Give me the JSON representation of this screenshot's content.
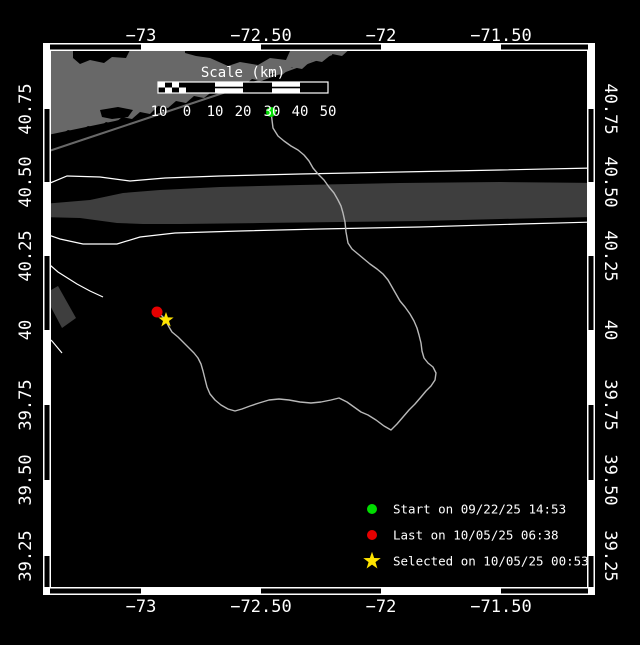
{
  "colors": {
    "background": "#000000",
    "sea": "#000000",
    "land": "#686868",
    "lane": "#3e3e3e",
    "boundary_line": "#ffffff",
    "track": "#b8b8b8",
    "start": "#00dd00",
    "last": "#e60000",
    "selected": "#ffe400",
    "frame": "#ffffff",
    "text": "#ffffff"
  },
  "axes": {
    "x": {
      "labels": [
        "−73",
        "−72.50",
        "−72",
        "−71.50"
      ],
      "ticks": [
        141,
        261,
        381,
        501
      ],
      "black_segments": [
        [
          50,
          141
        ],
        [
          261,
          381
        ],
        [
          501,
          588
        ]
      ]
    },
    "y": {
      "labels": [
        "40.75",
        "40.50",
        "40.25",
        "40",
        "39.75",
        "39.50",
        "39.25"
      ],
      "ticks": [
        109,
        182,
        256,
        330,
        405,
        480,
        556
      ],
      "black_segments": [
        [
          109,
          182
        ],
        [
          256,
          330
        ],
        [
          405,
          480
        ],
        [
          556,
          587
        ]
      ]
    }
  },
  "scale_bar": {
    "title": "Scale (km)",
    "title_x": 243,
    "title_y": 77,
    "bar": {
      "x": 158,
      "y": 82,
      "width": 170,
      "height": 11
    },
    "segments": [
      {
        "type": "checker",
        "x": 158,
        "w": 28
      },
      {
        "type": "dark",
        "x": 186,
        "w": 29
      },
      {
        "type": "striped",
        "x": 215,
        "w": 28
      },
      {
        "type": "dark",
        "x": 243,
        "w": 29
      },
      {
        "type": "striped",
        "x": 272,
        "w": 28
      },
      {
        "type": "dark",
        "x": 300,
        "w": 28
      }
    ],
    "labels": [
      {
        "text": "10",
        "x": 159
      },
      {
        "text": "0",
        "x": 187
      },
      {
        "text": "10",
        "x": 215
      },
      {
        "text": "20",
        "x": 243
      },
      {
        "text": "30",
        "x": 272
      },
      {
        "text": "40",
        "x": 300
      },
      {
        "text": "50",
        "x": 328
      }
    ],
    "label_y": 116
  },
  "markers": {
    "start": {
      "x": 271,
      "y": 112
    },
    "last": {
      "x": 157,
      "y": 312
    },
    "selected": {
      "x": 166,
      "y": 320
    }
  },
  "legend": {
    "marker_x": 372,
    "text_x": 393,
    "rows": [
      {
        "y": 509,
        "marker": "start",
        "label": "Start on 09/22/25 14:53"
      },
      {
        "y": 535,
        "marker": "last",
        "label": "Last on 10/05/25 06:38"
      },
      {
        "y": 561,
        "marker": "selected",
        "label": "Selected on 10/05/25 00:53"
      }
    ]
  },
  "map": {
    "polygons": [
      {
        "name": "land-long-island",
        "fill": "land",
        "points": [
          [
            43,
            142
          ],
          [
            60,
            135
          ],
          [
            68,
            130
          ],
          [
            78,
            132
          ],
          [
            88,
            126
          ],
          [
            98,
            128
          ],
          [
            106,
            122
          ],
          [
            114,
            124
          ],
          [
            122,
            117
          ],
          [
            132,
            119
          ],
          [
            140,
            112
          ],
          [
            150,
            114
          ],
          [
            158,
            106
          ],
          [
            168,
            108
          ],
          [
            176,
            101
          ],
          [
            186,
            103
          ],
          [
            194,
            96
          ],
          [
            204,
            98
          ],
          [
            214,
            90
          ],
          [
            224,
            92
          ],
          [
            232,
            85
          ],
          [
            242,
            87
          ],
          [
            252,
            79
          ],
          [
            262,
            81
          ],
          [
            272,
            73
          ],
          [
            282,
            75
          ],
          [
            292,
            67
          ],
          [
            302,
            69
          ],
          [
            312,
            60
          ],
          [
            322,
            62
          ],
          [
            332,
            54
          ],
          [
            342,
            56
          ],
          [
            352,
            47
          ],
          [
            358,
            43
          ],
          [
            43,
            43
          ]
        ]
      },
      {
        "name": "lagoon-bay",
        "fill": "sea",
        "points": [
          [
            43,
            136
          ],
          [
            115,
            121
          ],
          [
            126,
            118
          ],
          [
            120,
            127
          ],
          [
            100,
            133
          ],
          [
            80,
            141
          ],
          [
            60,
            148
          ],
          [
            43,
            151
          ]
        ]
      },
      {
        "name": "bay-west",
        "fill": "sea",
        "points": [
          [
            73,
            50
          ],
          [
            130,
            50
          ],
          [
            126,
            58
          ],
          [
            112,
            57
          ],
          [
            104,
            63
          ],
          [
            90,
            60
          ],
          [
            80,
            64
          ],
          [
            73,
            58
          ]
        ]
      },
      {
        "name": "bay-east",
        "fill": "sea",
        "points": [
          [
            185,
            51
          ],
          [
            290,
            51
          ],
          [
            286,
            60
          ],
          [
            270,
            58
          ],
          [
            258,
            65
          ],
          [
            240,
            62
          ],
          [
            228,
            66
          ],
          [
            210,
            58
          ],
          [
            196,
            56
          ],
          [
            185,
            53
          ]
        ]
      },
      {
        "name": "bay-small",
        "fill": "sea",
        "points": [
          [
            100,
            110
          ],
          [
            118,
            107
          ],
          [
            133,
            110
          ],
          [
            128,
            117
          ],
          [
            112,
            119
          ],
          [
            102,
            117
          ]
        ]
      },
      {
        "name": "shipping-lane-main",
        "fill": "lane",
        "points": [
          [
            43,
            204
          ],
          [
            90,
            200
          ],
          [
            123,
            193
          ],
          [
            160,
            190
          ],
          [
            220,
            187
          ],
          [
            300,
            185
          ],
          [
            400,
            183
          ],
          [
            500,
            182
          ],
          [
            595,
            183
          ],
          [
            595,
            217
          ],
          [
            500,
            219
          ],
          [
            420,
            221
          ],
          [
            340,
            222
          ],
          [
            260,
            223
          ],
          [
            180,
            224
          ],
          [
            143,
            224
          ],
          [
            117,
            223
          ],
          [
            80,
            218
          ],
          [
            43,
            217
          ]
        ]
      },
      {
        "name": "shipping-lane-southwest",
        "fill": "lane",
        "points": [
          [
            44,
            294
          ],
          [
            58,
            286
          ],
          [
            76,
            318
          ],
          [
            62,
            328
          ]
        ]
      }
    ],
    "polylines": [
      {
        "name": "barrier-island",
        "stroke": "land",
        "width": 2,
        "points": [
          [
            43,
            153
          ],
          [
            70,
            144
          ],
          [
            100,
            134
          ],
          [
            130,
            124
          ],
          [
            160,
            114
          ],
          [
            190,
            104
          ],
          [
            220,
            94
          ],
          [
            250,
            84
          ],
          [
            280,
            73
          ],
          [
            310,
            62
          ],
          [
            332,
            54
          ]
        ]
      },
      {
        "name": "lane-boundary-north",
        "stroke": "boundary_line",
        "width": 1.2,
        "points": [
          [
            43,
            186
          ],
          [
            67,
            176
          ],
          [
            100,
            177
          ],
          [
            130,
            181
          ],
          [
            165,
            178
          ],
          [
            220,
            176
          ],
          [
            300,
            174
          ],
          [
            400,
            172
          ],
          [
            500,
            170
          ],
          [
            595,
            168
          ]
        ]
      },
      {
        "name": "lane-boundary-south",
        "stroke": "boundary_line",
        "width": 1.2,
        "points": [
          [
            43,
            233
          ],
          [
            60,
            239
          ],
          [
            83,
            244
          ],
          [
            117,
            244
          ],
          [
            140,
            237
          ],
          [
            175,
            233
          ],
          [
            240,
            231
          ],
          [
            320,
            229
          ],
          [
            420,
            227
          ],
          [
            520,
            224
          ],
          [
            595,
            222
          ]
        ]
      },
      {
        "name": "lane-boundary-branch",
        "stroke": "boundary_line",
        "width": 1.2,
        "points": [
          [
            43,
            259
          ],
          [
            58,
            272
          ],
          [
            77,
            284
          ],
          [
            90,
            291
          ],
          [
            103,
            297
          ]
        ]
      },
      {
        "name": "lane-boundary-lower-left",
        "stroke": "boundary_line",
        "width": 1.2,
        "points": [
          [
            43,
            334
          ],
          [
            52,
            341
          ],
          [
            62,
            353
          ]
        ]
      }
    ]
  },
  "track": {
    "points": [
      [
        271,
        112
      ],
      [
        272,
        120
      ],
      [
        273,
        128
      ],
      [
        278,
        136
      ],
      [
        284,
        141
      ],
      [
        291,
        146
      ],
      [
        298,
        150
      ],
      [
        304,
        155
      ],
      [
        309,
        161
      ],
      [
        313,
        168
      ],
      [
        318,
        174
      ],
      [
        324,
        180
      ],
      [
        329,
        187
      ],
      [
        334,
        193
      ],
      [
        338,
        200
      ],
      [
        341,
        206
      ],
      [
        343,
        213
      ],
      [
        345,
        222
      ],
      [
        346,
        232
      ],
      [
        348,
        243
      ],
      [
        352,
        249
      ],
      [
        358,
        254
      ],
      [
        364,
        259
      ],
      [
        370,
        264
      ],
      [
        377,
        269
      ],
      [
        383,
        274
      ],
      [
        388,
        280
      ],
      [
        392,
        287
      ],
      [
        396,
        294
      ],
      [
        400,
        301
      ],
      [
        405,
        307
      ],
      [
        410,
        314
      ],
      [
        414,
        321
      ],
      [
        417,
        328
      ],
      [
        419,
        335
      ],
      [
        421,
        343
      ],
      [
        422,
        351
      ],
      [
        424,
        358
      ],
      [
        428,
        363
      ],
      [
        433,
        367
      ],
      [
        436,
        373
      ],
      [
        435,
        380
      ],
      [
        431,
        386
      ],
      [
        426,
        391
      ],
      [
        421,
        397
      ],
      [
        415,
        404
      ],
      [
        409,
        410
      ],
      [
        403,
        417
      ],
      [
        397,
        424
      ],
      [
        391,
        430
      ],
      [
        384,
        426
      ],
      [
        376,
        420
      ],
      [
        368,
        415
      ],
      [
        361,
        412
      ],
      [
        354,
        407
      ],
      [
        347,
        402
      ],
      [
        339,
        398
      ],
      [
        331,
        400
      ],
      [
        321,
        402
      ],
      [
        311,
        403
      ],
      [
        300,
        402
      ],
      [
        289,
        400
      ],
      [
        279,
        399
      ],
      [
        269,
        400
      ],
      [
        259,
        403
      ],
      [
        250,
        406
      ],
      [
        242,
        409
      ],
      [
        235,
        411
      ],
      [
        228,
        409
      ],
      [
        221,
        405
      ],
      [
        215,
        400
      ],
      [
        210,
        394
      ],
      [
        207,
        387
      ],
      [
        205,
        379
      ],
      [
        203,
        371
      ],
      [
        201,
        364
      ],
      [
        198,
        358
      ],
      [
        194,
        353
      ],
      [
        189,
        348
      ],
      [
        184,
        343
      ],
      [
        178,
        337
      ],
      [
        172,
        332
      ],
      [
        169,
        327
      ],
      [
        167,
        323
      ],
      [
        166,
        320
      ],
      [
        162,
        316
      ],
      [
        158,
        313
      ]
    ]
  }
}
